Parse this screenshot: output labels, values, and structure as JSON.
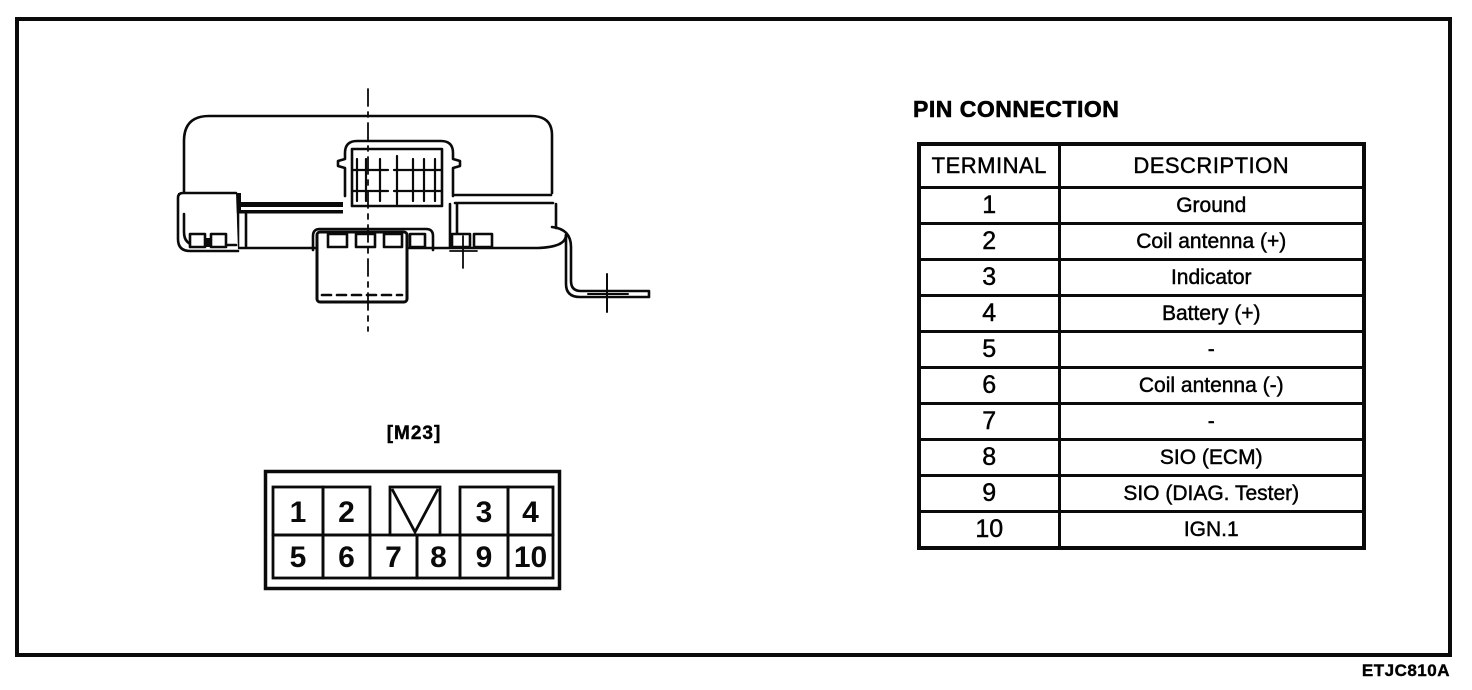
{
  "connector": {
    "label": "[M23]",
    "top_pins": [
      "1",
      "2",
      "3",
      "4"
    ],
    "bottom_pins": [
      "5",
      "6",
      "7",
      "8",
      "9",
      "10"
    ]
  },
  "pin_table": {
    "title": "PIN CONNECTION",
    "headers": [
      "TERMINAL",
      "DESCRIPTION"
    ],
    "rows": [
      {
        "terminal": "1",
        "description": "Ground"
      },
      {
        "terminal": "2",
        "description": "Coil antenna (+)"
      },
      {
        "terminal": "3",
        "description": "Indicator"
      },
      {
        "terminal": "4",
        "description": "Battery (+)"
      },
      {
        "terminal": "5",
        "description": "-"
      },
      {
        "terminal": "6",
        "description": "Coil antenna (-)"
      },
      {
        "terminal": "7",
        "description": "-"
      },
      {
        "terminal": "8",
        "description": "SIO (ECM)"
      },
      {
        "terminal": "9",
        "description": "SIO (DIAG. Tester)"
      },
      {
        "terminal": "10",
        "description": "IGN.1"
      }
    ]
  },
  "footer": {
    "figure_code": "ETJC810A"
  }
}
